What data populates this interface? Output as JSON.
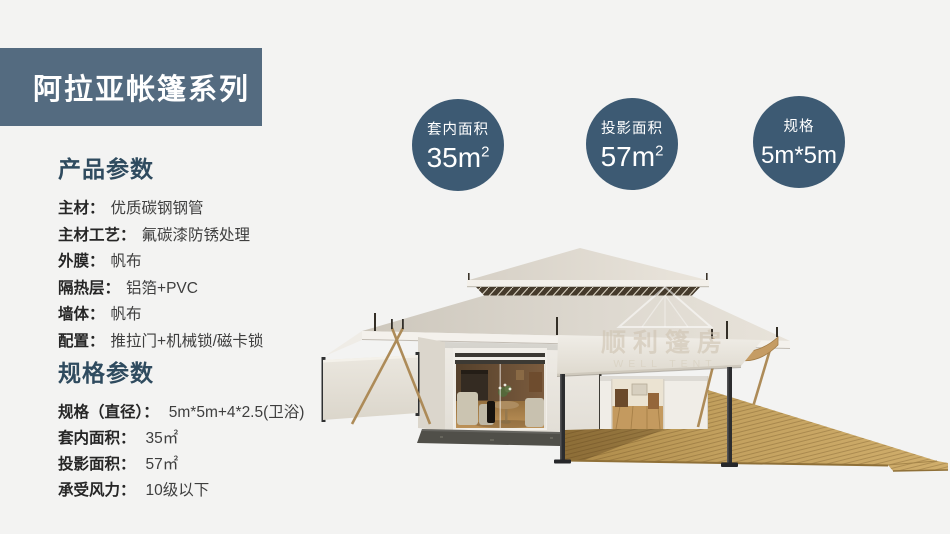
{
  "banner": {
    "title": "阿拉亚帐篷系列",
    "bg_color": "#546b80",
    "text_color": "#ffffff"
  },
  "stats": {
    "circle_color": "#3d5a73",
    "items": [
      {
        "label": "套内面积",
        "value": "35m",
        "sup": "2"
      },
      {
        "label": "投影面积",
        "value": "57m",
        "sup": "2"
      },
      {
        "label": "规格",
        "value": "5m*5m",
        "sup": ""
      }
    ]
  },
  "product": {
    "title": "产品参数",
    "items": [
      {
        "label": "主材：",
        "value": "优质碳钢钢管"
      },
      {
        "label": "主材工艺：",
        "value": "氟碳漆防锈处理"
      },
      {
        "label": "外膜：",
        "value": "帆布"
      },
      {
        "label": "隔热层：",
        "value": "铝箔+PVC"
      },
      {
        "label": "墙体：",
        "value": "帆布"
      },
      {
        "label": "配置：",
        "value": "推拉门+机械锁/磁卡锁"
      }
    ]
  },
  "spec": {
    "title": "规格参数",
    "items": [
      {
        "label": "规格（直径）：",
        "value": "5m*5m+4*2.5(卫浴)"
      },
      {
        "label": "套内面积：",
        "value": "35㎡"
      },
      {
        "label": "投影面积：",
        "value": "57㎡"
      },
      {
        "label": "承受风力：",
        "value": "10级以下"
      }
    ]
  },
  "watermark": {
    "cn": "顺利篷房",
    "en": "WELL TENT"
  },
  "palette": {
    "page_bg": "#f3f3f2",
    "heading_color": "#2f4b5f",
    "label_color": "#262626",
    "value_color": "#3e3e3e",
    "roof_canvas": "#e0dbd2",
    "deck_wood": "#c2a05e",
    "stone_base": "#504f49"
  }
}
